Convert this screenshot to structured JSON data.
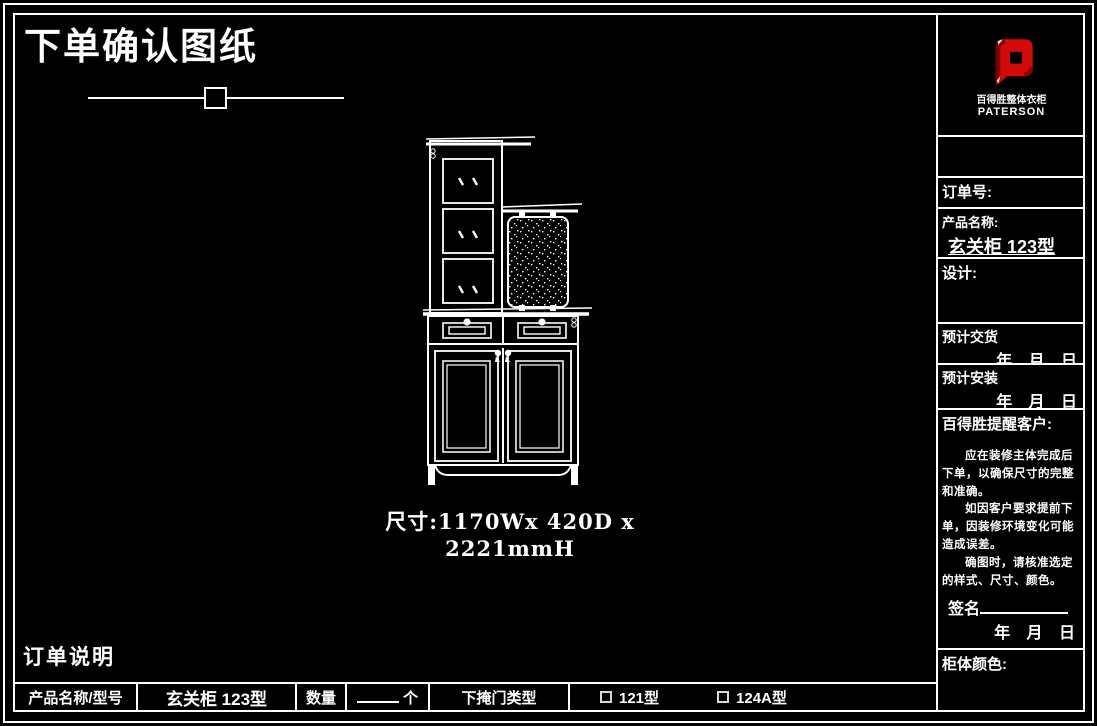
{
  "title": "下单确认图纸",
  "drawing": {
    "dimension_text": "尺寸:1170Wx 420D x 2221mmH"
  },
  "sidebar": {
    "logo": {
      "brand_cn": "百得胜整体衣柜",
      "brand_en": "PATERSON",
      "color": "#d40a0a"
    },
    "order_no_label": "订单号:",
    "product_name_label": "产品名称:",
    "product_name_value": "玄关柜 123型",
    "design_label": "设计:",
    "delivery_label": "预计交货",
    "delivery_date": "年 月 日",
    "install_label": "预计安装",
    "install_date": "年 月 日",
    "notice_title": "百得胜提醒客户:",
    "notice_lines": [
      "应在装修主体完成后下单，以确保尺寸的完整和准确。",
      "如因客户要求提前下单，因装修环境变化可能造成误差。",
      "确图时，请核准选定的样式、尺寸、颜色。"
    ],
    "sign_label": "签名",
    "sign_date": "年 月 日",
    "cabinet_color_label": "柜体颜色:"
  },
  "footer": {
    "order_note_label": "订单说明",
    "product_label": "产品名称/型号",
    "product_value": "玄关柜 123型",
    "qty_label": "数量",
    "qty_unit": "个",
    "door_type_label": "下掩门类型",
    "options": [
      {
        "label": "121型"
      },
      {
        "label": "124A型"
      }
    ]
  },
  "colors": {
    "background": "#000000",
    "line": "#ffffff",
    "logo_red": "#d40a0a"
  }
}
